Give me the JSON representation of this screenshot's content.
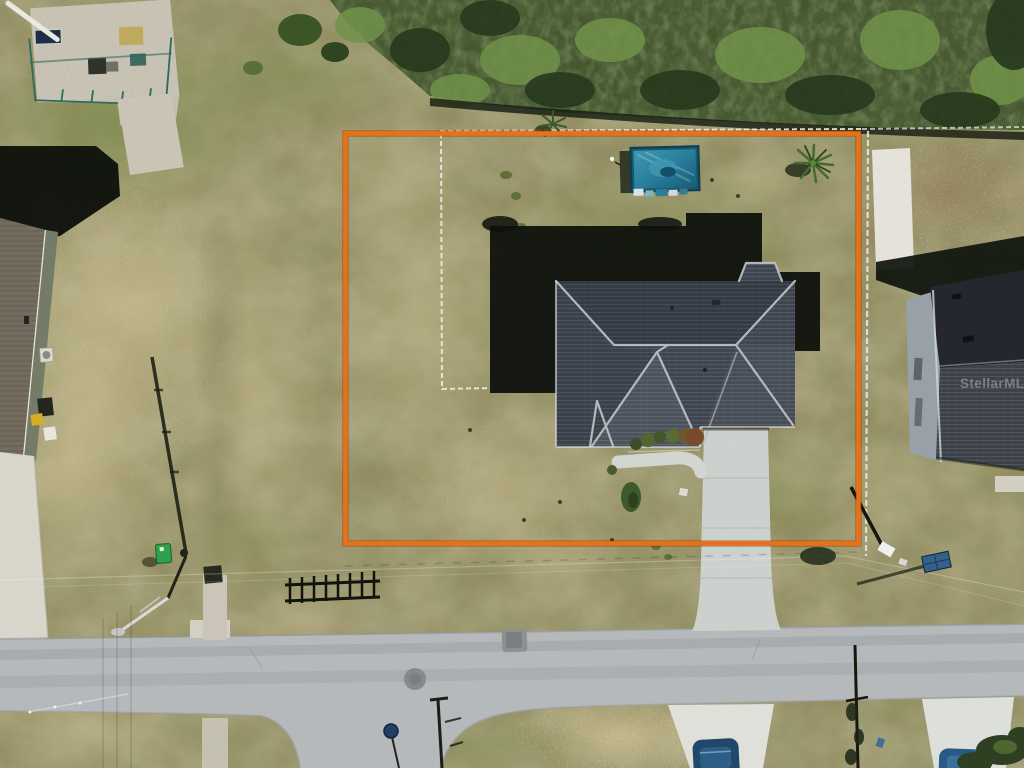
{
  "meta": {
    "type": "aerial-drone-photograph",
    "subject": "residential vacant-corner lot with single-family home, pool enclosure trampoline, and highlighted parcel boundary"
  },
  "watermark": {
    "text": "StellarMLS"
  },
  "overlay": {
    "boundary_shape": "rectangle",
    "boundary_color": "#ed6f13"
  },
  "colors": {
    "boundary_orange": "#ed6f13",
    "watermark_white": "rgba(255,255,255,0.58)",
    "grass_olive": "#938d62",
    "grass_tan": "#c9bd92",
    "vegetation_dark": "#2a3d1e",
    "vegetation_bright": "#71924a",
    "road_asphalt": "#b5b8ba",
    "concrete_light": "#d8d5ca",
    "roof_shingle_gray": "#3f4650",
    "roof_ridge_light": "#bfc5cb",
    "neighbor_roof_dark": "#24282e",
    "pool_teal": "#2b82a0",
    "shadow_dark": "#0d110c",
    "vehicle_navy": "#20486a",
    "fence_white": "#eceae2",
    "sign_navy": "#1f3f66",
    "utility_green": "#2da24a",
    "solar_panel_blue": "#33618c"
  },
  "scene": {
    "objects": [
      "utility-station",
      "brush-vegetation",
      "left-neighbor-house",
      "right-neighbor-house",
      "subject-house-roof",
      "house-shadow",
      "trampoline-pool",
      "palm-tree",
      "backyard-fence",
      "driveway",
      "front-walkway",
      "road",
      "side-road",
      "stop-sign",
      "street-light-pole",
      "power-lines",
      "parked-vehicles",
      "property-boundary-overlay",
      "mls-watermark"
    ]
  }
}
